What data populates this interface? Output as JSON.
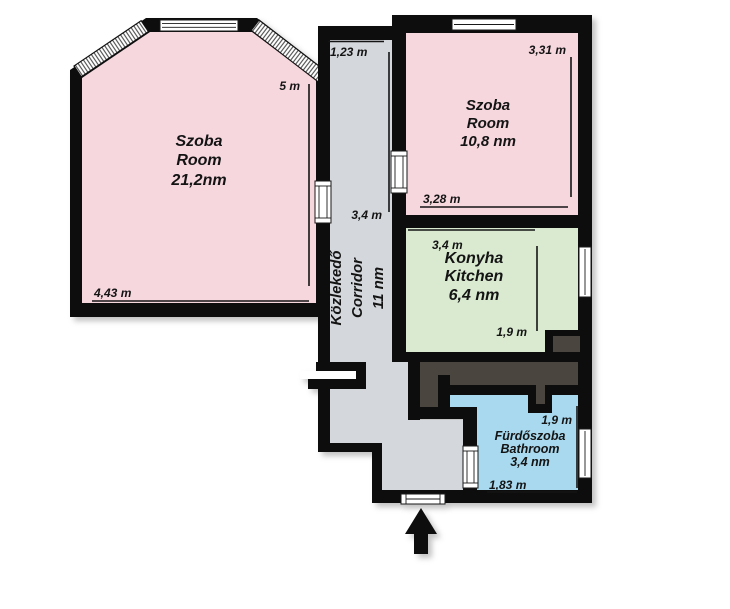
{
  "plan": {
    "title": "apartment floor plan",
    "rooms": {
      "living": {
        "name_hu": "Szoba",
        "name_en": "Room",
        "area": "21,2nm"
      },
      "bedroom": {
        "name_hu": "Szoba",
        "name_en": "Room",
        "area": "10,8 nm"
      },
      "kitchen": {
        "name_hu": "Konyha",
        "name_en": "Kitchen",
        "area": "6,4 nm"
      },
      "corridor": {
        "name_hu": "Közlekedő",
        "name_en": "Corridor",
        "area": "11 nm"
      },
      "bathroom": {
        "name_hu": "Fürdőszoba",
        "name_en": "Bathroom",
        "area": "3,4 nm"
      }
    },
    "dimensions": {
      "living_width": "4,43 m",
      "living_height": "5 m",
      "corridor_entry_width": "1,23 m",
      "corridor_length": "3,4 m",
      "bedroom_height": "3,31 m",
      "bedroom_width": "3,28 m",
      "kitchen_width": "3,4 m",
      "kitchen_depth": "1,9 m",
      "bathroom_depth": "1,9 m",
      "bathroom_width": "1,83 m"
    },
    "colors": {
      "room_pink": "#f6d7de",
      "kitchen_green": "#d9ead0",
      "bathroom_blue": "#a8d9ee",
      "corridor_gray": "#d4d7db",
      "mass_dark": "#4a453f",
      "wall_black": "#0d0d0d"
    }
  }
}
